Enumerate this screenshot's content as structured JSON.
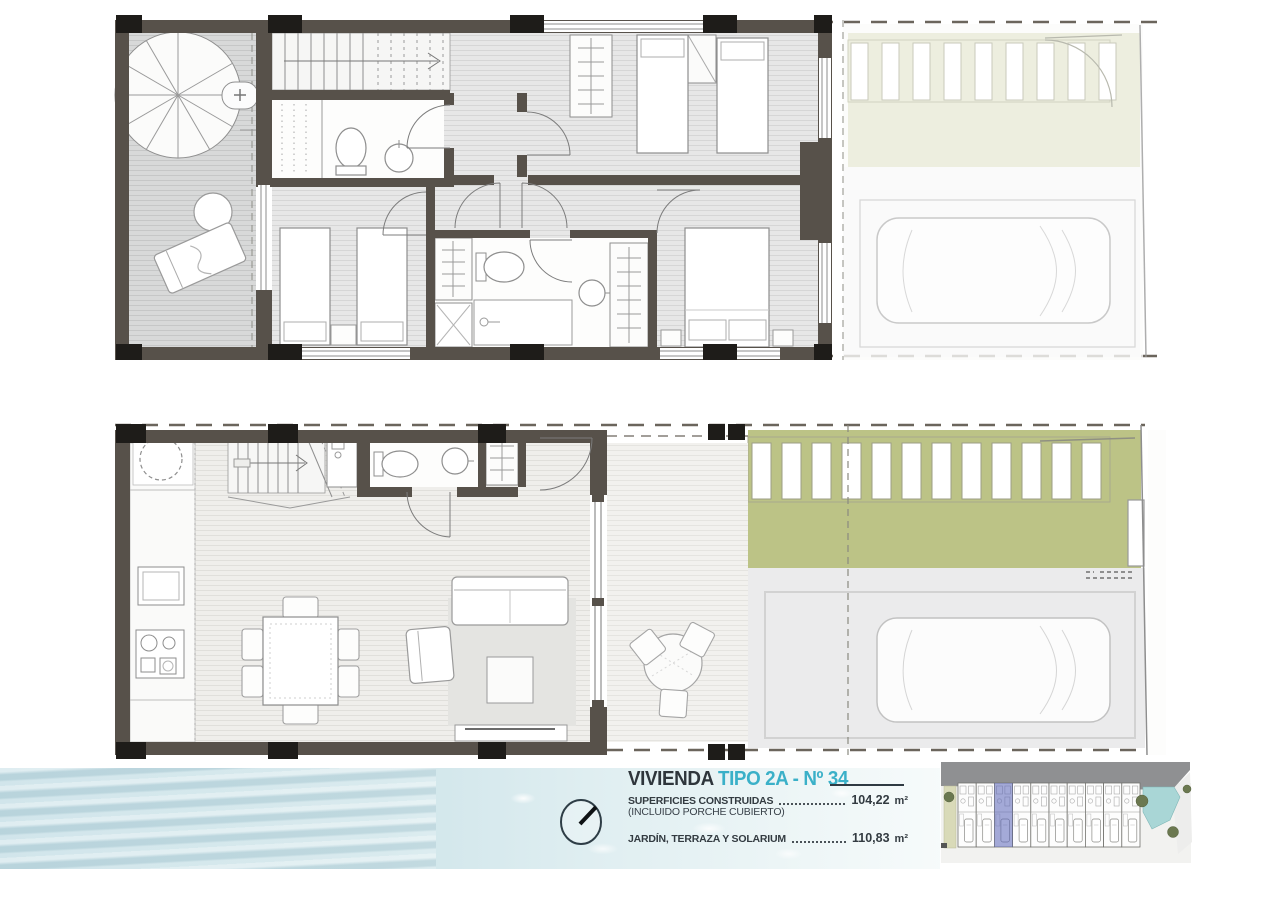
{
  "title_block": {
    "title_main": "VIVIENDA",
    "title_type": "TIPO 2A - Nº 34",
    "rows": [
      {
        "label": "SUPERFICIES CONSTRUIDAS",
        "note": "(INCLUIDO PORCHE CUBIERTO)",
        "value": "104,22",
        "unit": "m²"
      },
      {
        "label": "JARDÍN, TERRAZA Y SOLARIUM",
        "value": "110,83",
        "unit": "m²"
      }
    ]
  },
  "floors": {
    "upper_floor": {
      "zones": [
        "terrace-solarium",
        "spiral-staircase",
        "staircase",
        "bathroom-1",
        "hallway",
        "bedroom-1",
        "bedroom-2",
        "bedroom-3",
        "bathroom-2",
        "garden-faded",
        "parking-faded"
      ]
    },
    "ground_floor": {
      "zones": [
        "kitchen",
        "living-dining",
        "staircase",
        "bathroom",
        "covered-porch",
        "garden",
        "pergola",
        "parking"
      ]
    }
  },
  "site_plan": {
    "units_total": 10,
    "highlighted_unit": 3,
    "features": [
      "street",
      "pool",
      "trees",
      "row-of-townhouses"
    ]
  },
  "icons": {
    "compass": "north-compass-icon"
  },
  "colors": {
    "accent_cyan": "#3ab0c8",
    "wall": "#57514a",
    "column_black": "#1e1c19",
    "garden_green": "#bcc386",
    "garden_faded": "#e9ebd8",
    "water": "#cfe5ea",
    "highlight_unit": "#7d85c6",
    "road": "#8f9092",
    "pool": "#a9d6d6"
  }
}
